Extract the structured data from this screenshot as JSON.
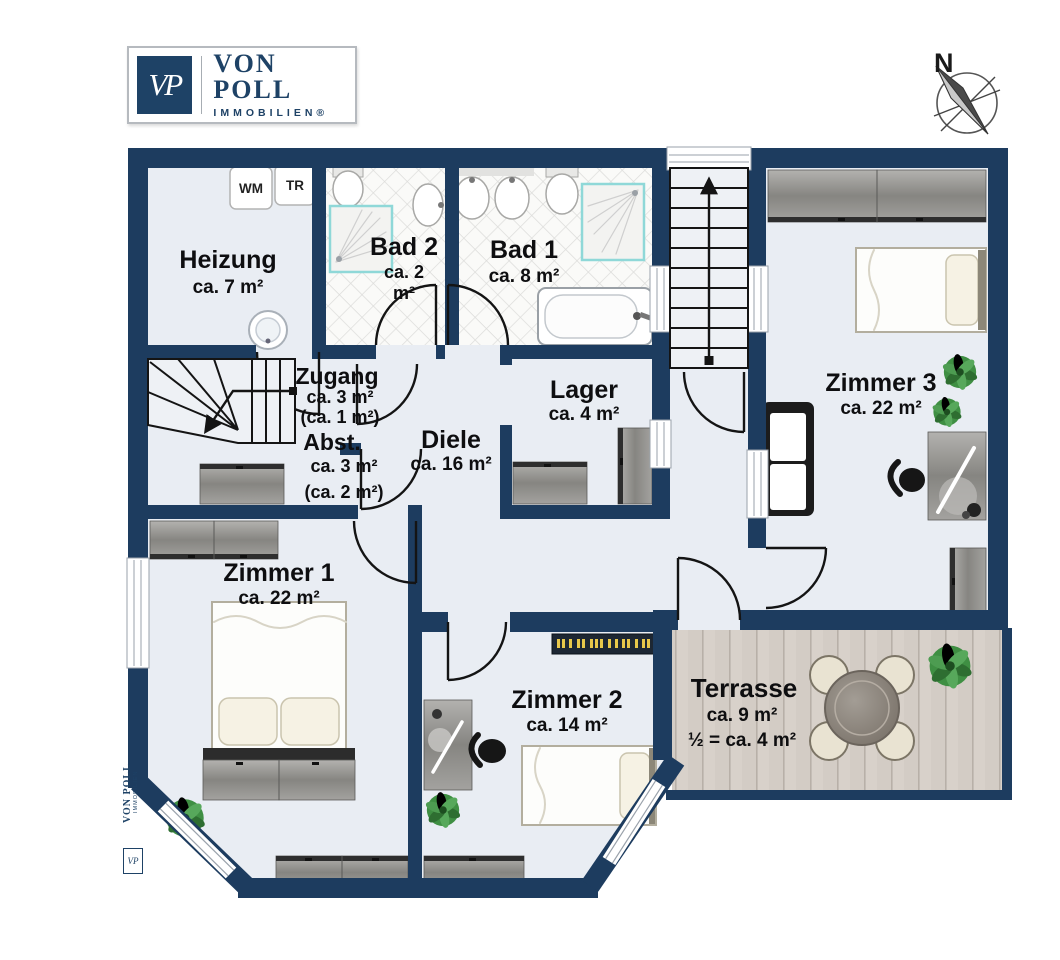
{
  "brand": {
    "initials": "VP",
    "name": "VON POLL",
    "subtitle": "IMMOBILIEN®"
  },
  "compass": {
    "north_label": "N"
  },
  "watermark": {
    "name": "VON POLL",
    "subtitle": "IMMOBILIEN",
    "initials": "VP"
  },
  "appliances": {
    "washing_machine": "WM",
    "dryer": "TR"
  },
  "rooms": {
    "heizung": {
      "name": "Heizung",
      "area": "ca. 7 m²"
    },
    "bad2": {
      "name": "Bad 2",
      "area": "ca. 2 m²"
    },
    "bad1": {
      "name": "Bad 1",
      "area": "ca. 8 m²"
    },
    "zugang": {
      "name": "Zugang",
      "area": "ca. 3 m²",
      "area_note": "(ca. 1 m²)"
    },
    "abst": {
      "name": "Abst.",
      "area": "ca. 3 m²",
      "area_note": "(ca. 2 m²)"
    },
    "diele": {
      "name": "Diele",
      "area": "ca. 16 m²"
    },
    "lager": {
      "name": "Lager",
      "area": "ca. 4 m²"
    },
    "zimmer1": {
      "name": "Zimmer 1",
      "area": "ca. 22 m²"
    },
    "zimmer2": {
      "name": "Zimmer 2",
      "area": "ca. 14 m²"
    },
    "zimmer3": {
      "name": "Zimmer 3",
      "area": "ca. 22 m²"
    },
    "terrasse": {
      "name": "Terrasse",
      "area": "ca. 9 m²",
      "area_note": "½ = ca. 4 m²"
    }
  },
  "colors": {
    "wall": "#1d3c5f",
    "floor": "#e9edf3",
    "brand_navy": "#1e4266",
    "terrace_deck": "#d3ccc5"
  }
}
